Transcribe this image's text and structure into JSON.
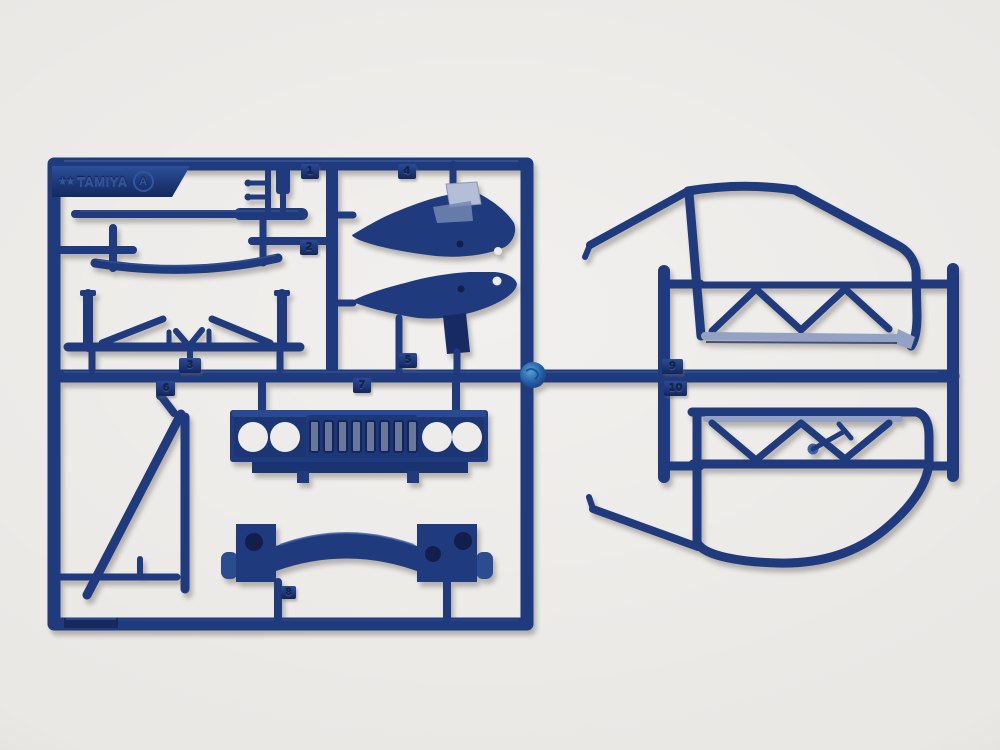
{
  "brand_plate": {
    "star_glyph": "★",
    "brand": "TAMIYA",
    "sprue_letter": "A"
  },
  "part_tags": [
    "1",
    "2",
    "3",
    "4",
    "5",
    "6",
    "7",
    "8",
    "9",
    "10"
  ],
  "grille": {
    "slot_count": 8,
    "headlight_hole_count": 4
  },
  "colors": {
    "background": "#eae8e5",
    "navy": "#1f3a7d",
    "navy_dark": "#13255a",
    "navy_mid": "#2a4c93",
    "navy_light": "#3d60ac",
    "sheen": "#93a2c4",
    "flap": "#b4bed6",
    "slot_inner": "#68779a",
    "hole_dark": "#121f4d",
    "hole_light": "#edecea",
    "blob_light": "#59a0d6",
    "blob": "#2563a8",
    "emboss": "#32549e"
  }
}
